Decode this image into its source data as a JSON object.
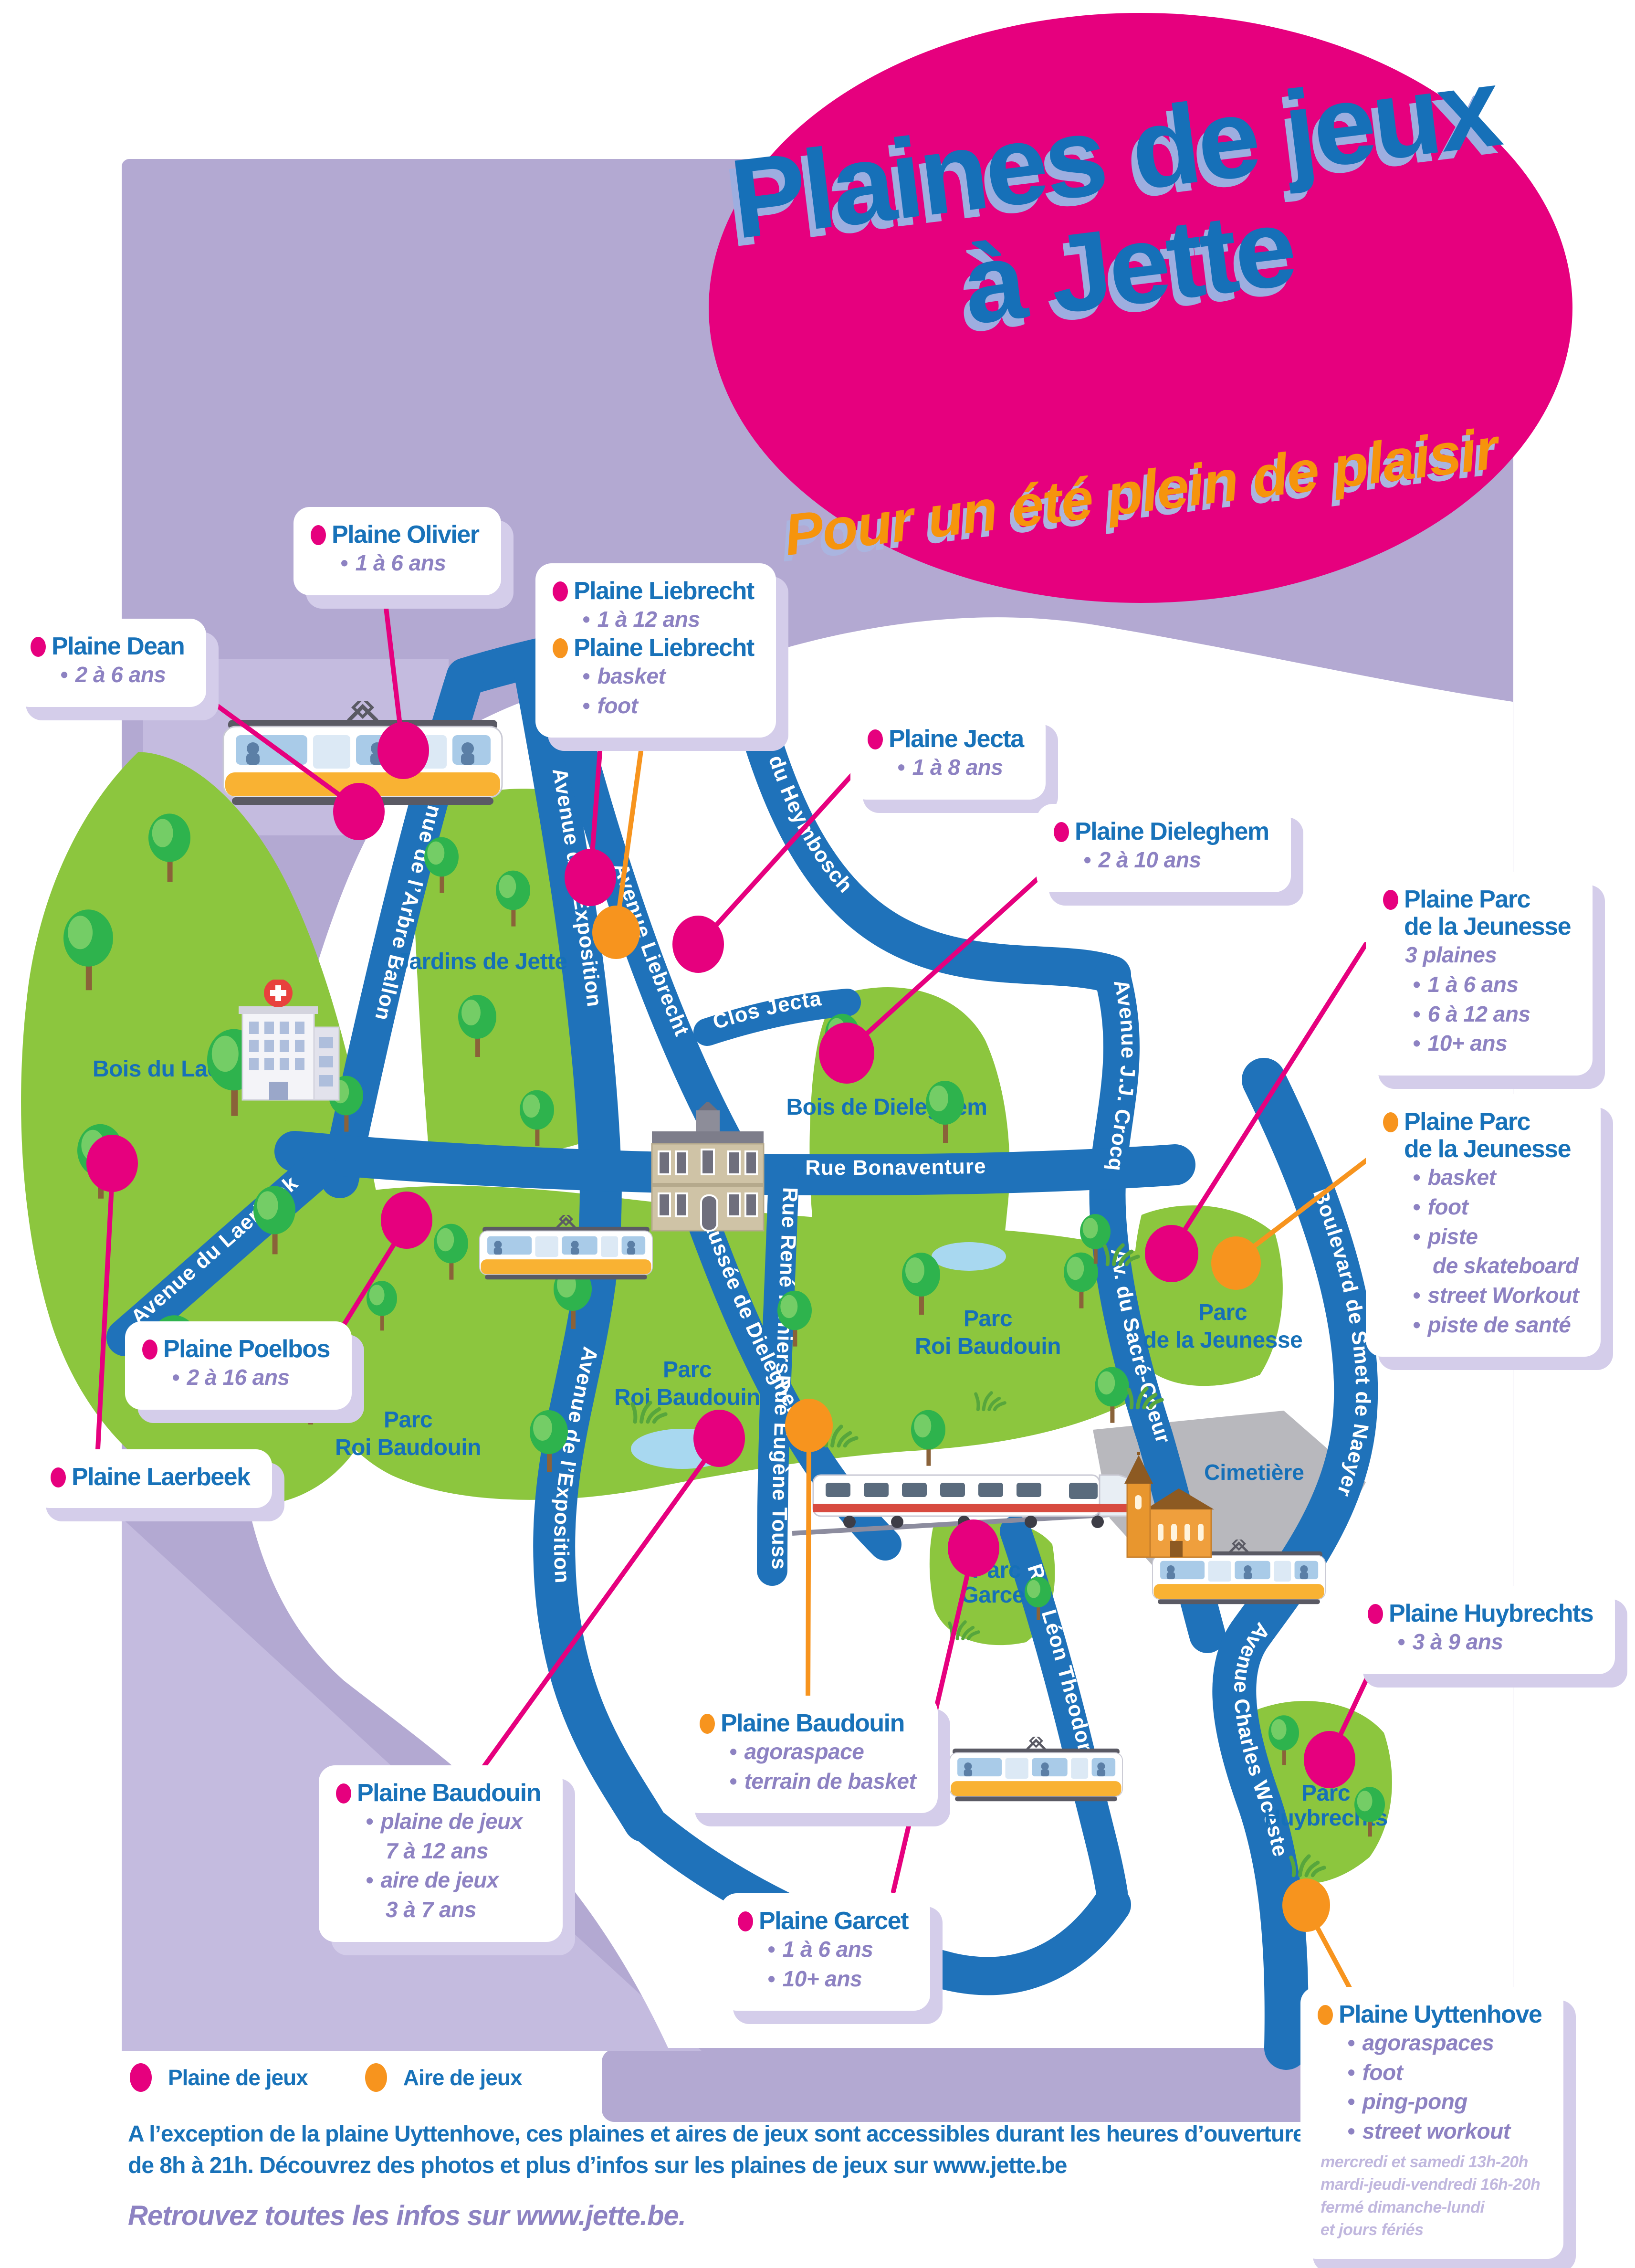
{
  "poster": {
    "title_line1": "Plaines de jeux",
    "title_line2": "à Jette",
    "subtitle": "Pour un été plein de plaisir"
  },
  "legend": {
    "plaine_label": "Plaine de jeux",
    "aire_label": "Aire de jeux"
  },
  "footer": {
    "line1": "A l’exception de la plaine Uyttenhove, ces plaines et aires de jeux sont accessibles durant les heures d’ouverture des parcs,",
    "line2": "de 8h à 21h. Découvrez des photos et plus d’infos sur les plaines de jeux sur www.jette.be",
    "tagline": "Retrouvez toutes les infos sur www.jette.be."
  },
  "callouts": {
    "olivier": {
      "title": "Plaine Olivier",
      "age": "1 à 6 ans"
    },
    "dean": {
      "title": "Plaine Dean",
      "age": "2 à 6 ans"
    },
    "liebrecht_plaine": {
      "title": "Plaine Liebrecht",
      "age": "1 à 12 ans"
    },
    "liebrecht_aire": {
      "title": "Plaine Liebrecht",
      "items": [
        "basket",
        "foot"
      ]
    },
    "jecta": {
      "title": "Plaine Jecta",
      "age": "1 à 8 ans"
    },
    "dieleghem": {
      "title": "Plaine Dieleghem",
      "age": "2 à 10 ans"
    },
    "jeunesse_plaine": {
      "title_line1": "Plaine Parc",
      "title_line2": "de la Jeunesse",
      "note": "3 plaines",
      "items": [
        "1 à 6 ans",
        "6 à 12 ans",
        "10+ ans"
      ]
    },
    "jeunesse_aire": {
      "title_line1": "Plaine Parc",
      "title_line2": "de la Jeunesse",
      "items": [
        "basket",
        "foot",
        "piste",
        "de skateboard",
        "street Workout",
        "piste de santé"
      ]
    },
    "poelbos": {
      "title": "Plaine Poelbos",
      "age": "2 à 16 ans"
    },
    "laerbeek": {
      "title": "Plaine Laerbeek"
    },
    "baudouin_aire": {
      "title": "Plaine Baudouin",
      "items": [
        "agoraspace",
        "terrain de basket"
      ]
    },
    "baudouin_plaine": {
      "title": "Plaine Baudouin",
      "items": [
        "plaine de jeux",
        "7 à 12 ans",
        "aire de jeux",
        "3 à 7 ans"
      ]
    },
    "garcet": {
      "title": "Plaine Garcet",
      "items": [
        "1 à 6 ans",
        "10+ ans"
      ]
    },
    "huybrechts": {
      "title": "Plaine Huybrechts",
      "age": "3 à 9 ans"
    },
    "uyttenhove": {
      "title": "Plaine Uyttenhove",
      "items": [
        "agoraspaces",
        "foot",
        "ping-pong",
        "street workout"
      ],
      "schedule": [
        "mercredi et samedi 13h-20h",
        "mardi-jeudi-vendredi 16h-20h",
        "fermé dimanche-lundi",
        "et jours fériés"
      ]
    }
  },
  "map": {
    "streets": {
      "arbre_ballon": "Avenue de l’Arbre Ballon",
      "exposition": "Avenue de l’Exposition",
      "heymbosch": "Avenue du Heymbosch",
      "jj_crocq": "Avenue J.J. Crocq",
      "sacre_coeur": "Av. du Sacré-Coeur",
      "liebrecht": "Avenue Liebrecht",
      "clos_jecta": "Clos Jecta",
      "bonaventure": "Rue  Bonaventure",
      "laerbeek": "Avenue du Laerbeek",
      "chaussee_dieleghem": "Chaussée de Dieleghem",
      "rene_reniers": "Rue René Reniers",
      "eugene_toussaint": "Rue Eugène Toussaint",
      "smet_naeyer": "Boulevard de Smet de Naeyer",
      "charles_woeste": "Avenue Charles Woeste",
      "leon_theodor": "Rue Léon Theodor"
    },
    "places": {
      "jardins_jette": "Jardins de Jette",
      "bois_laerbeek": "Bois du Laerbeek",
      "bois_dieleghem": "Bois de Dieleghem",
      "parc": "Parc",
      "roi_baudouin": "Roi Baudouin",
      "de_la_jeunesse": "de la Jeunesse",
      "garcet": "Garcet",
      "huybrechts": "Huybrechts",
      "cimetiere": "Cimetière"
    }
  }
}
